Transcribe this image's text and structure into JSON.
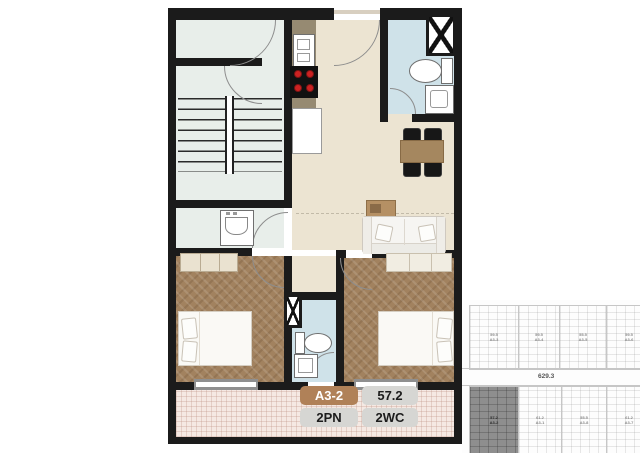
{
  "unit_card": {
    "code": "A3-2",
    "area": "57.2",
    "bedrooms": "2PN",
    "bathrooms": "2WC"
  },
  "colors": {
    "badge_brown": "#b08158",
    "badge_gray": "#d6d6d3",
    "wall": "#1b1b1b",
    "wood_floor": "#a2825f",
    "bathroom_floor": "#cfe2e9",
    "stair_floor": "#e8eeea",
    "main_floor": "#ece4d2",
    "balcony_floor": "#f5e9e3"
  },
  "minimap": {
    "corridor_area": "629.3",
    "units_top": [
      {
        "area": "59.5",
        "code": "A3-3"
      },
      {
        "area": "59.5",
        "code": "A3-4"
      },
      {
        "area": "55.5",
        "code": "A3-5"
      },
      {
        "area": "59.5",
        "code": "A3-6"
      }
    ],
    "units_bottom": [
      {
        "area": "57.2",
        "code": "A3-2"
      },
      {
        "area": "61.2",
        "code": "A3-1"
      },
      {
        "area": "55.5",
        "code": "A3-8"
      },
      {
        "area": "61.2",
        "code": "A3-7"
      }
    ]
  }
}
